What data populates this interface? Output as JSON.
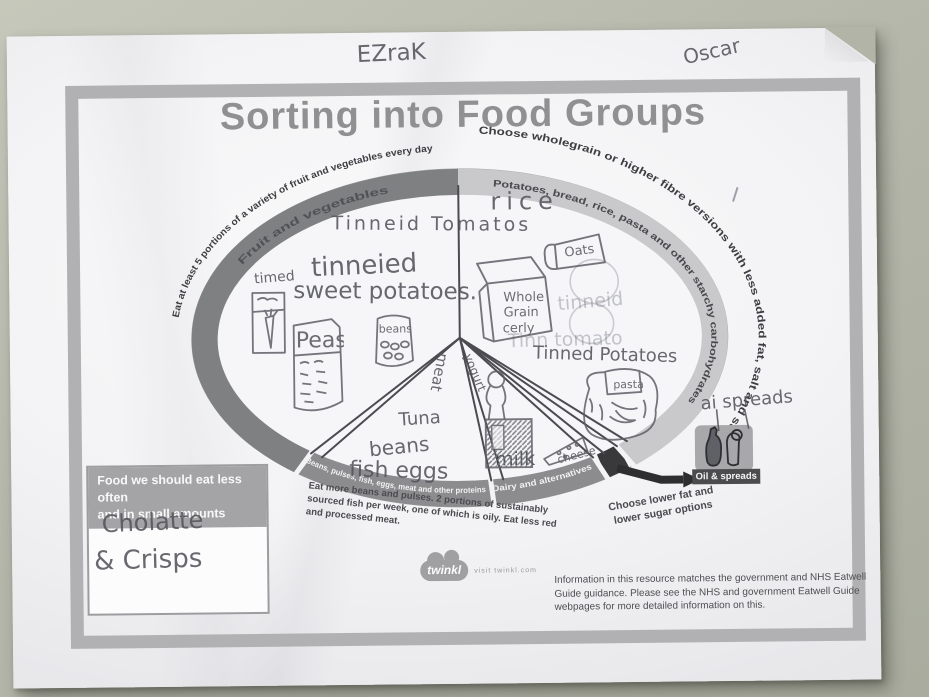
{
  "doc": {
    "title": "Sorting into Food Groups",
    "names": {
      "left": "EZraK",
      "right": "Oscar"
    }
  },
  "fv": {
    "arc": "Eat at least 5 portions of a variety of fruit and vegetables every day",
    "band": "Fruit and vegetables",
    "tomatoes": "Tinneid Tomatos",
    "sweet1": "tinneied",
    "sweet2": "sweet potatoes.",
    "tinned": "timed",
    "peas": "Peas",
    "beans_tin": "beans"
  },
  "st": {
    "arc": "Choose wholegrain or higher fibre versions with less added fat, salt and sugar",
    "band": "Potatoes, bread, rice, pasta and other starchy carbohydrates",
    "rice": "rice",
    "box1": "Whole",
    "box2": "Grain",
    "box3": "cerly",
    "oats": "Oats",
    "faint1": "tinneid",
    "faint2": "Tinn tomato",
    "tinned_potatoes": "Tinned Potatoes",
    "pasta": "pasta"
  },
  "pr": {
    "band": "Beans, pulses, fish, eggs, meat and other proteins",
    "note": "Eat more beans and pulses. 2 portions of sustainably sourced fish per week, one of which is oily. Eat less red and processed meat.",
    "meat": "meat",
    "tuna": "Tuna",
    "beans": "beans",
    "fish_eggs": "fish eggs"
  },
  "dy": {
    "band": "Dairy and alternatives",
    "note": "Choose lower fat and lower sugar options",
    "yogurt": "yogurt",
    "milk": "milk",
    "cheese": "cheese"
  },
  "oil": {
    "label": "Oil & spreads",
    "hw": "ai spreads"
  },
  "lo": {
    "h1": "Food we should eat less often",
    "h2": "and in small amounts",
    "hw1": "Cholatte",
    "hw2": "& Crisps"
  },
  "ft": {
    "logo": "twinkl",
    "visit": "visit twinkl.com",
    "info": "Information in this resource matches the government and NHS Eatwell Guide guidance. Please see the NHS and government Eatwell Guide webpages for more detailed information on this."
  },
  "colors": {
    "desk": "#b5b7ab",
    "paper": "#f3f3f5",
    "frame": "#b1b1b3",
    "title": "#909092",
    "band_dark": "#7f8082",
    "band_light": "#c9c9cb",
    "band_mid": "#8c8c8e",
    "oils_black": "#39393b",
    "pencil": "#54545c"
  }
}
